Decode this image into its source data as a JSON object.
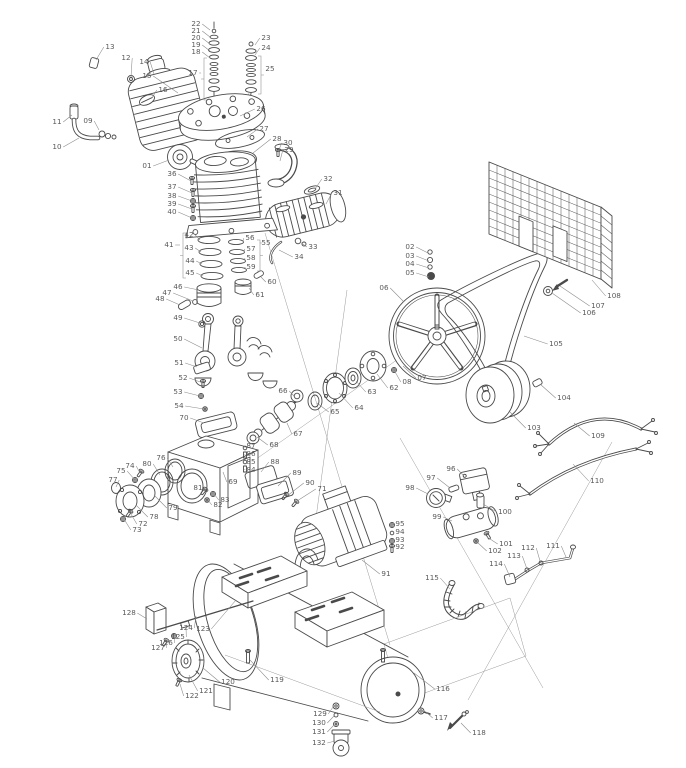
{
  "figure": {
    "type": "exploded-parts-diagram",
    "subject": "belt-driven air compressor (pump head, flywheel, belt guard, motor, manifold, tank)",
    "canvas": {
      "width": 686,
      "height": 768
    }
  },
  "colors": {
    "background": "#ffffff",
    "line": "#4a4a4a",
    "leader": "#8a8a8a",
    "label": "#5a5a5a"
  },
  "callouts": [
    {
      "n": "01",
      "x": 147,
      "y": 166,
      "tx": 169,
      "ty": 160
    },
    {
      "n": "02",
      "x": 410,
      "y": 247,
      "tx": 428,
      "ty": 253
    },
    {
      "n": "03",
      "x": 410,
      "y": 256,
      "tx": 429,
      "ty": 261
    },
    {
      "n": "04",
      "x": 410,
      "y": 264,
      "tx": 429,
      "ty": 268
    },
    {
      "n": "05",
      "x": 410,
      "y": 273,
      "tx": 429,
      "ty": 277
    },
    {
      "n": "06",
      "x": 384,
      "y": 288,
      "tx": 404,
      "ty": 302
    },
    {
      "n": "07",
      "x": 422,
      "y": 378,
      "tx": 403,
      "ty": 366
    },
    {
      "n": "08",
      "x": 407,
      "y": 382,
      "tx": 394,
      "ty": 370
    },
    {
      "n": "09",
      "x": 88,
      "y": 121,
      "tx": 99,
      "ty": 130
    },
    {
      "n": "10",
      "x": 57,
      "y": 147,
      "tx": 79,
      "ty": 138
    },
    {
      "n": "11",
      "x": 57,
      "y": 122,
      "tx": 72,
      "ty": 115
    },
    {
      "n": "12",
      "x": 126,
      "y": 58,
      "tx": 131,
      "ty": 77
    },
    {
      "n": "13",
      "x": 110,
      "y": 47,
      "tx": 96,
      "ty": 60
    },
    {
      "n": "14",
      "x": 144,
      "y": 62,
      "tx": 154,
      "ty": 74
    },
    {
      "n": "15",
      "x": 147,
      "y": 76,
      "tx": 178,
      "ty": 93
    },
    {
      "n": "16",
      "x": 163,
      "y": 90,
      "tx": 152,
      "ty": 98
    },
    {
      "n": "17",
      "x": 193,
      "y": 73,
      "tx": 201,
      "ty": 73
    },
    {
      "n": "18",
      "x": 196,
      "y": 52,
      "tx": 210,
      "ty": 58
    },
    {
      "n": "19",
      "x": 196,
      "y": 45,
      "tx": 210,
      "ty": 51
    },
    {
      "n": "20",
      "x": 196,
      "y": 38,
      "tx": 210,
      "ty": 44
    },
    {
      "n": "21",
      "x": 196,
      "y": 31,
      "tx": 210,
      "ty": 37
    },
    {
      "n": "22",
      "x": 196,
      "y": 24,
      "tx": 210,
      "ty": 30
    },
    {
      "n": "23",
      "x": 266,
      "y": 38,
      "tx": 255,
      "ty": 45
    },
    {
      "n": "24",
      "x": 266,
      "y": 48,
      "tx": 255,
      "ty": 55
    },
    {
      "n": "25",
      "x": 270,
      "y": 69,
      "tx": 264,
      "ty": 69
    },
    {
      "n": "26",
      "x": 261,
      "y": 109,
      "tx": 240,
      "ty": 116
    },
    {
      "n": "27",
      "x": 264,
      "y": 129,
      "tx": 247,
      "ty": 137
    },
    {
      "n": "28",
      "x": 277,
      "y": 139,
      "tx": 253,
      "ty": 153
    },
    {
      "n": "29",
      "x": 289,
      "y": 150,
      "tx": 280,
      "ty": 161
    },
    {
      "n": "30",
      "x": 288,
      "y": 143,
      "tx": 278,
      "ty": 152
    },
    {
      "n": "31",
      "x": 338,
      "y": 193,
      "tx": 326,
      "ty": 204
    },
    {
      "n": "32",
      "x": 328,
      "y": 179,
      "tx": 315,
      "ty": 189
    },
    {
      "n": "33",
      "x": 313,
      "y": 247,
      "tx": 300,
      "ty": 242
    },
    {
      "n": "34",
      "x": 299,
      "y": 257,
      "tx": 279,
      "ty": 250
    },
    {
      "n": "36",
      "x": 172,
      "y": 174,
      "tx": 191,
      "ty": 181
    },
    {
      "n": "37",
      "x": 172,
      "y": 187,
      "tx": 192,
      "ty": 193
    },
    {
      "n": "38",
      "x": 172,
      "y": 196,
      "tx": 192,
      "ty": 201
    },
    {
      "n": "39",
      "x": 172,
      "y": 204,
      "tx": 192,
      "ty": 209
    },
    {
      "n": "40",
      "x": 172,
      "y": 212,
      "tx": 192,
      "ty": 218
    },
    {
      "n": "41",
      "x": 169,
      "y": 245,
      "tx": 180,
      "ty": 245
    },
    {
      "n": "42",
      "x": 189,
      "y": 235,
      "tx": 200,
      "ty": 240
    },
    {
      "n": "43",
      "x": 189,
      "y": 248,
      "tx": 201,
      "ty": 252
    },
    {
      "n": "44",
      "x": 190,
      "y": 261,
      "tx": 202,
      "ty": 264
    },
    {
      "n": "45",
      "x": 190,
      "y": 273,
      "tx": 203,
      "ty": 276
    },
    {
      "n": "46",
      "x": 178,
      "y": 287,
      "tx": 199,
      "ty": 290
    },
    {
      "n": "47",
      "x": 167,
      "y": 293,
      "tx": 193,
      "ty": 301
    },
    {
      "n": "48",
      "x": 160,
      "y": 299,
      "tx": 180,
      "ty": 305
    },
    {
      "n": "49",
      "x": 178,
      "y": 318,
      "tx": 200,
      "ty": 323
    },
    {
      "n": "50",
      "x": 178,
      "y": 339,
      "tx": 202,
      "ty": 348
    },
    {
      "n": "51",
      "x": 179,
      "y": 363,
      "tx": 197,
      "ty": 367
    },
    {
      "n": "52",
      "x": 183,
      "y": 378,
      "tx": 203,
      "ty": 383
    },
    {
      "n": "53",
      "x": 178,
      "y": 392,
      "tx": 200,
      "ty": 396
    },
    {
      "n": "54",
      "x": 179,
      "y": 406,
      "tx": 204,
      "ty": 409
    },
    {
      "n": "55",
      "x": 266,
      "y": 243,
      "tx": 262,
      "ty": 243
    },
    {
      "n": "56",
      "x": 250,
      "y": 238,
      "tx": 243,
      "ty": 242
    },
    {
      "n": "57",
      "x": 251,
      "y": 249,
      "tx": 244,
      "ty": 252
    },
    {
      "n": "58",
      "x": 251,
      "y": 258,
      "tx": 245,
      "ty": 261
    },
    {
      "n": "59",
      "x": 251,
      "y": 267,
      "tx": 246,
      "ty": 270
    },
    {
      "n": "60",
      "x": 272,
      "y": 282,
      "tx": 261,
      "ty": 277
    },
    {
      "n": "61",
      "x": 260,
      "y": 295,
      "tx": 249,
      "ty": 288
    },
    {
      "n": "62",
      "x": 394,
      "y": 388,
      "tx": 377,
      "ty": 374
    },
    {
      "n": "63",
      "x": 372,
      "y": 392,
      "tx": 356,
      "ty": 381
    },
    {
      "n": "64",
      "x": 359,
      "y": 408,
      "tx": 339,
      "ty": 393
    },
    {
      "n": "65",
      "x": 335,
      "y": 412,
      "tx": 317,
      "ty": 403
    },
    {
      "n": "66",
      "x": 283,
      "y": 391,
      "tx": 294,
      "ty": 396
    },
    {
      "n": "67",
      "x": 298,
      "y": 434,
      "tx": 287,
      "ty": 423
    },
    {
      "n": "68",
      "x": 274,
      "y": 445,
      "tx": 257,
      "ty": 437
    },
    {
      "n": "69",
      "x": 233,
      "y": 482,
      "tx": 223,
      "ty": 472
    },
    {
      "n": "70",
      "x": 184,
      "y": 418,
      "tx": 204,
      "ty": 423
    },
    {
      "n": "71",
      "x": 322,
      "y": 489,
      "tx": 297,
      "ty": 501
    },
    {
      "n": "72",
      "x": 143,
      "y": 524,
      "tx": 131,
      "ty": 514
    },
    {
      "n": "73",
      "x": 137,
      "y": 530,
      "tx": 124,
      "ty": 519
    },
    {
      "n": "74",
      "x": 130,
      "y": 466,
      "tx": 140,
      "ty": 473
    },
    {
      "n": "75",
      "x": 121,
      "y": 471,
      "tx": 135,
      "ty": 480
    },
    {
      "n": "76",
      "x": 161,
      "y": 458,
      "tx": 173,
      "ty": 467
    },
    {
      "n": "77",
      "x": 113,
      "y": 480,
      "tx": 116,
      "ty": 487
    },
    {
      "n": "78",
      "x": 154,
      "y": 517,
      "tx": 136,
      "ty": 505
    },
    {
      "n": "79",
      "x": 173,
      "y": 508,
      "tx": 154,
      "ty": 495
    },
    {
      "n": "80",
      "x": 147,
      "y": 464,
      "tx": 160,
      "ty": 475
    },
    {
      "n": "81",
      "x": 198,
      "y": 488,
      "tx": 205,
      "ty": 491
    },
    {
      "n": "82",
      "x": 218,
      "y": 505,
      "tx": 208,
      "ty": 500
    },
    {
      "n": "83",
      "x": 225,
      "y": 500,
      "tx": 214,
      "ty": 494
    },
    {
      "n": "84",
      "x": 251,
      "y": 470,
      "tx": 245,
      "ty": 469
    },
    {
      "n": "85",
      "x": 251,
      "y": 462,
      "tx": 245,
      "ty": 462
    },
    {
      "n": "86",
      "x": 251,
      "y": 454,
      "tx": 245,
      "ty": 455
    },
    {
      "n": "87",
      "x": 251,
      "y": 446,
      "tx": 245,
      "ty": 448
    },
    {
      "n": "88",
      "x": 275,
      "y": 462,
      "tx": 261,
      "ty": 472
    },
    {
      "n": "89",
      "x": 297,
      "y": 473,
      "tx": 278,
      "ty": 486
    },
    {
      "n": "90",
      "x": 310,
      "y": 483,
      "tx": 287,
      "ty": 496
    },
    {
      "n": "91",
      "x": 386,
      "y": 574,
      "tx": 362,
      "ty": 560
    },
    {
      "n": "92",
      "x": 400,
      "y": 547,
      "tx": 393,
      "ty": 548
    },
    {
      "n": "93",
      "x": 400,
      "y": 540,
      "tx": 393,
      "ty": 541
    },
    {
      "n": "94",
      "x": 400,
      "y": 532,
      "tx": 393,
      "ty": 533
    },
    {
      "n": "95",
      "x": 400,
      "y": 524,
      "tx": 393,
      "ty": 526
    },
    {
      "n": "96",
      "x": 451,
      "y": 469,
      "tx": 464,
      "ty": 476
    },
    {
      "n": "97",
      "x": 431,
      "y": 478,
      "tx": 450,
      "ty": 488
    },
    {
      "n": "98",
      "x": 410,
      "y": 488,
      "tx": 428,
      "ty": 494
    },
    {
      "n": "99",
      "x": 437,
      "y": 517,
      "tx": 452,
      "ty": 521
    },
    {
      "n": "100",
      "x": 505,
      "y": 512,
      "tx": 483,
      "ty": 504
    },
    {
      "n": "101",
      "x": 506,
      "y": 544,
      "tx": 487,
      "ty": 537
    },
    {
      "n": "102",
      "x": 495,
      "y": 551,
      "tx": 477,
      "ty": 542
    },
    {
      "n": "103",
      "x": 534,
      "y": 428,
      "tx": 510,
      "ty": 412
    },
    {
      "n": "104",
      "x": 564,
      "y": 398,
      "tx": 540,
      "ty": 384
    },
    {
      "n": "105",
      "x": 556,
      "y": 344,
      "tx": 524,
      "ty": 336
    },
    {
      "n": "106",
      "x": 589,
      "y": 313,
      "tx": 552,
      "ty": 293
    },
    {
      "n": "107",
      "x": 598,
      "y": 306,
      "tx": 560,
      "ty": 286
    },
    {
      "n": "108",
      "x": 614,
      "y": 296,
      "tx": 592,
      "ty": 280
    },
    {
      "n": "109",
      "x": 598,
      "y": 436,
      "tx": 574,
      "ty": 423
    },
    {
      "n": "110",
      "x": 597,
      "y": 481,
      "tx": 573,
      "ty": 464
    },
    {
      "n": "111",
      "x": 553,
      "y": 546,
      "tx": 566,
      "ty": 557
    },
    {
      "n": "112",
      "x": 528,
      "y": 548,
      "tx": 540,
      "ty": 561
    },
    {
      "n": "113",
      "x": 514,
      "y": 556,
      "tx": 527,
      "ty": 569
    },
    {
      "n": "114",
      "x": 496,
      "y": 564,
      "tx": 510,
      "ty": 577
    },
    {
      "n": "115",
      "x": 432,
      "y": 578,
      "tx": 450,
      "ty": 589
    },
    {
      "n": "116",
      "x": 443,
      "y": 689,
      "tx": 414,
      "ty": 673
    },
    {
      "n": "117",
      "x": 441,
      "y": 718,
      "tx": 426,
      "ty": 712
    },
    {
      "n": "118",
      "x": 479,
      "y": 733,
      "tx": 461,
      "ty": 723
    },
    {
      "n": "119",
      "x": 277,
      "y": 680,
      "tx": 250,
      "ty": 660
    },
    {
      "n": "120",
      "x": 228,
      "y": 682,
      "tx": 203,
      "ty": 668
    },
    {
      "n": "121",
      "x": 206,
      "y": 691,
      "tx": 189,
      "ty": 675
    },
    {
      "n": "122",
      "x": 192,
      "y": 696,
      "tx": 180,
      "ty": 684
    },
    {
      "n": "123",
      "x": 203,
      "y": 629,
      "tx": 236,
      "ty": 600
    },
    {
      "n": "124",
      "x": 186,
      "y": 628,
      "tx": 196,
      "ty": 616
    },
    {
      "n": "125",
      "x": 178,
      "y": 637,
      "tx": 186,
      "ty": 626
    },
    {
      "n": "126",
      "x": 166,
      "y": 643,
      "tx": 175,
      "ty": 636
    },
    {
      "n": "127",
      "x": 158,
      "y": 648,
      "tx": 167,
      "ty": 642
    },
    {
      "n": "128",
      "x": 129,
      "y": 613,
      "tx": 147,
      "ty": 619
    },
    {
      "n": "129",
      "x": 320,
      "y": 714,
      "tx": 333,
      "ty": 707
    },
    {
      "n": "130",
      "x": 319,
      "y": 723,
      "tx": 334,
      "ty": 716
    },
    {
      "n": "131",
      "x": 319,
      "y": 732,
      "tx": 334,
      "ty": 725
    },
    {
      "n": "132",
      "x": 319,
      "y": 743,
      "tx": 335,
      "ty": 741
    }
  ],
  "brackets": [
    {
      "x": 204,
      "y1": 58,
      "y2": 100,
      "d": 1
    },
    {
      "x": 261,
      "y1": 56,
      "y2": 94,
      "d": -1
    },
    {
      "x": 183,
      "y1": 233,
      "y2": 278,
      "d": 1
    },
    {
      "x": 260,
      "y1": 240,
      "y2": 271,
      "d": -1
    }
  ]
}
